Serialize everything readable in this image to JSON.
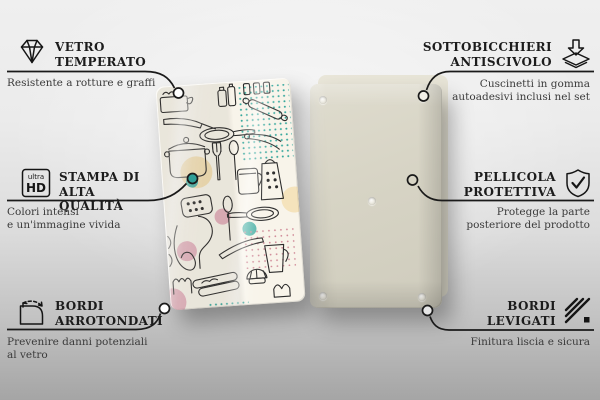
{
  "product": {
    "front_panel": "kitchen-utensils-line-art-print",
    "back_panel": "plain-back-with-anti-slip-pads"
  },
  "colors": {
    "text": "#1c1c1c",
    "connector_line": "#1a1a1a",
    "accent_teal": "#2f9e96",
    "accent_pink": "#dfa3b4",
    "accent_tan": "#f3dfb4",
    "front_panel_bg": "#f8f4ea",
    "back_panel_bg": "#d7d4c5",
    "background_top": "#efefef",
    "background_bottom": "#a5a5a5"
  },
  "icons": {
    "ultra_hd": {
      "line1": "ultra",
      "line2": "HD"
    }
  },
  "callouts": {
    "left": [
      {
        "icon": "diamond-icon",
        "title1": "VETRO",
        "title2": "TEMPERATO",
        "desc1": "Resistente a rotture e graffi",
        "desc2": ""
      },
      {
        "icon": "ultra-hd-icon",
        "title1": "STAMPA DI ALTA",
        "title2": "QUALITÀ",
        "desc1": "Colori intensi",
        "desc2": "e un'immagine vivida"
      },
      {
        "icon": "rounded-corner-icon",
        "title1": "BORDI",
        "title2": "ARROTONDATI",
        "desc1": "Prevenire danni potenziali",
        "desc2": "al vetro"
      }
    ],
    "right": [
      {
        "icon": "anti-slip-pad-icon",
        "title1": "SOTTOBICCHIERI",
        "title2": "ANTISCIVOLO",
        "desc1": "Cuscinetti in gomma",
        "desc2": "autoadesivi inclusi nel set"
      },
      {
        "icon": "shield-check-icon",
        "title1": "PELLICOLA",
        "title2": "PROTETTIVA",
        "desc1": "Protegge la parte",
        "desc2": "posteriore del prodotto"
      },
      {
        "icon": "smooth-edge-icon",
        "title1": "BORDI",
        "title2": "LEVIGATI",
        "desc1": "Finitura liscia e sicura",
        "desc2": ""
      }
    ]
  }
}
